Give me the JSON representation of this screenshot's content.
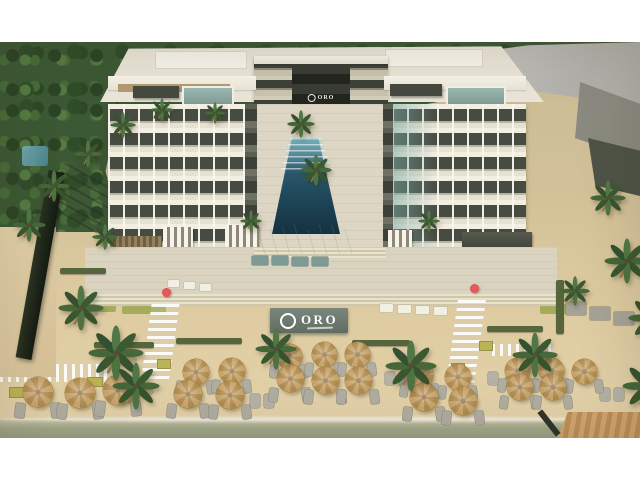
{
  "meta": {
    "type": "architectural-rendering",
    "subject": "Aerial rendering of the ORO beachfront resort: two white six-story condo buildings flanking a long central pool courtyard, beach-club decks with pergolas, palm trees, striped sand walkways, rows of straw umbrellas with loungers on the beach, shoreline water and a wooden boardwalk"
  },
  "branding": {
    "sign_text": "ORO",
    "facade_sign_text": "ORO"
  },
  "palette": {
    "letterbox": "#ffffff",
    "foliage": "#3d5835",
    "building_light": "#f0ebde",
    "balcony_dark": "#474c42",
    "glass_teal": "#87aca4",
    "neighbour_roof_gray": "#b8b7b1",
    "pool_teal": "#24556a",
    "sand": "#d9c69e",
    "pavement": "#dad3c1",
    "umbrella_straw": "#c2a069",
    "water_green": "#a0a78a",
    "sign_wall": "#6f7b72",
    "boardwalk_wood": "#c69a66",
    "accent_red": "#d4494d"
  },
  "scene": {
    "umbrellas": [
      {
        "x": 38,
        "y": 350,
        "d": 30
      },
      {
        "x": 80,
        "y": 351,
        "d": 30
      },
      {
        "x": 118,
        "y": 348,
        "d": 30
      },
      {
        "x": 196,
        "y": 330,
        "d": 26
      },
      {
        "x": 232,
        "y": 329,
        "d": 26
      },
      {
        "x": 188,
        "y": 352,
        "d": 28
      },
      {
        "x": 230,
        "y": 353,
        "d": 28
      },
      {
        "x": 289,
        "y": 314,
        "d": 25
      },
      {
        "x": 324,
        "y": 312,
        "d": 25
      },
      {
        "x": 357,
        "y": 312,
        "d": 25
      },
      {
        "x": 290,
        "y": 336,
        "d": 27
      },
      {
        "x": 325,
        "y": 338,
        "d": 27
      },
      {
        "x": 358,
        "y": 338,
        "d": 27
      },
      {
        "x": 420,
        "y": 333,
        "d": 26
      },
      {
        "x": 458,
        "y": 335,
        "d": 26
      },
      {
        "x": 424,
        "y": 355,
        "d": 28
      },
      {
        "x": 463,
        "y": 359,
        "d": 28
      },
      {
        "x": 517,
        "y": 328,
        "d": 25
      },
      {
        "x": 551,
        "y": 328,
        "d": 25
      },
      {
        "x": 584,
        "y": 329,
        "d": 25
      },
      {
        "x": 520,
        "y": 345,
        "d": 26
      },
      {
        "x": 553,
        "y": 345,
        "d": 26
      }
    ],
    "palms": [
      {
        "x": 58,
        "y": 243,
        "s": 46
      },
      {
        "x": 88,
        "y": 283,
        "s": 56
      },
      {
        "x": 112,
        "y": 320,
        "s": 48
      },
      {
        "x": 255,
        "y": 286,
        "s": 42
      },
      {
        "x": 385,
        "y": 298,
        "s": 52
      },
      {
        "x": 512,
        "y": 290,
        "s": 46
      },
      {
        "x": 287,
        "y": 68,
        "s": 28
      },
      {
        "x": 300,
        "y": 112,
        "s": 32
      },
      {
        "x": 92,
        "y": 182,
        "s": 26
      },
      {
        "x": 240,
        "y": 168,
        "s": 22
      },
      {
        "x": 418,
        "y": 168,
        "s": 22
      },
      {
        "x": 560,
        "y": 234,
        "s": 30
      },
      {
        "x": 604,
        "y": 196,
        "s": 46
      },
      {
        "x": 628,
        "y": 252,
        "s": 48
      },
      {
        "x": 590,
        "y": 138,
        "s": 36
      },
      {
        "x": 622,
        "y": 318,
        "s": 52
      },
      {
        "x": 38,
        "y": 128,
        "s": 32
      },
      {
        "x": 12,
        "y": 166,
        "s": 34
      },
      {
        "x": 74,
        "y": 98,
        "s": 28
      },
      {
        "x": 110,
        "y": 70,
        "s": 26
      },
      {
        "x": 150,
        "y": 56,
        "s": 24
      },
      {
        "x": 204,
        "y": 60,
        "s": 22
      }
    ],
    "furniture": [
      {
        "x": 380,
        "y": 262,
        "w": 13,
        "h": 8,
        "t": "white"
      },
      {
        "x": 398,
        "y": 263,
        "w": 13,
        "h": 8,
        "t": "white"
      },
      {
        "x": 416,
        "y": 264,
        "w": 13,
        "h": 8,
        "t": "white"
      },
      {
        "x": 434,
        "y": 265,
        "w": 13,
        "h": 8,
        "t": "white"
      },
      {
        "x": 252,
        "y": 214,
        "w": 16,
        "h": 9,
        "t": "teal"
      },
      {
        "x": 272,
        "y": 214,
        "w": 16,
        "h": 9,
        "t": "teal"
      },
      {
        "x": 292,
        "y": 215,
        "w": 16,
        "h": 9,
        "t": "teal"
      },
      {
        "x": 312,
        "y": 215,
        "w": 16,
        "h": 9,
        "t": "teal"
      },
      {
        "x": 566,
        "y": 260,
        "w": 20,
        "h": 13,
        "t": "gray"
      },
      {
        "x": 590,
        "y": 265,
        "w": 20,
        "h": 13,
        "t": "gray"
      },
      {
        "x": 614,
        "y": 270,
        "w": 20,
        "h": 13,
        "t": "gray"
      },
      {
        "x": 168,
        "y": 238,
        "w": 11,
        "h": 7,
        "t": "white"
      },
      {
        "x": 184,
        "y": 240,
        "w": 11,
        "h": 7,
        "t": "white"
      },
      {
        "x": 200,
        "y": 242,
        "w": 11,
        "h": 7,
        "t": "white"
      },
      {
        "x": 250,
        "y": 352,
        "w": 10,
        "h": 14,
        "t": "lounger"
      },
      {
        "x": 264,
        "y": 352,
        "w": 10,
        "h": 14,
        "t": "lounger"
      },
      {
        "x": 385,
        "y": 330,
        "w": 10,
        "h": 13,
        "t": "lounger"
      },
      {
        "x": 399,
        "y": 331,
        "w": 10,
        "h": 13,
        "t": "lounger"
      },
      {
        "x": 488,
        "y": 330,
        "w": 10,
        "h": 13,
        "t": "lounger"
      },
      {
        "x": 600,
        "y": 346,
        "w": 10,
        "h": 13,
        "t": "lounger"
      },
      {
        "x": 614,
        "y": 346,
        "w": 10,
        "h": 13,
        "t": "lounger"
      }
    ],
    "hedges": [
      {
        "x": 94,
        "y": 300,
        "w": 60,
        "h": 6
      },
      {
        "x": 176,
        "y": 296,
        "w": 66,
        "h": 6
      },
      {
        "x": 352,
        "y": 298,
        "w": 58,
        "h": 6
      },
      {
        "x": 487,
        "y": 284,
        "w": 56,
        "h": 6
      },
      {
        "x": 556,
        "y": 238,
        "w": 8,
        "h": 54
      },
      {
        "x": 60,
        "y": 226,
        "w": 46,
        "h": 6
      }
    ],
    "planters": [
      {
        "x": 88,
        "y": 336,
        "w": 14,
        "h": 8
      },
      {
        "x": 158,
        "y": 318,
        "w": 12,
        "h": 8
      },
      {
        "x": 452,
        "y": 322,
        "w": 12,
        "h": 8
      },
      {
        "x": 480,
        "y": 300,
        "w": 12,
        "h": 8
      },
      {
        "x": 506,
        "y": 336,
        "w": 12,
        "h": 8
      },
      {
        "x": 10,
        "y": 346,
        "w": 14,
        "h": 9
      }
    ],
    "red_umbrellas": [
      {
        "x": 162,
        "y": 246
      },
      {
        "x": 470,
        "y": 242
      }
    ]
  }
}
